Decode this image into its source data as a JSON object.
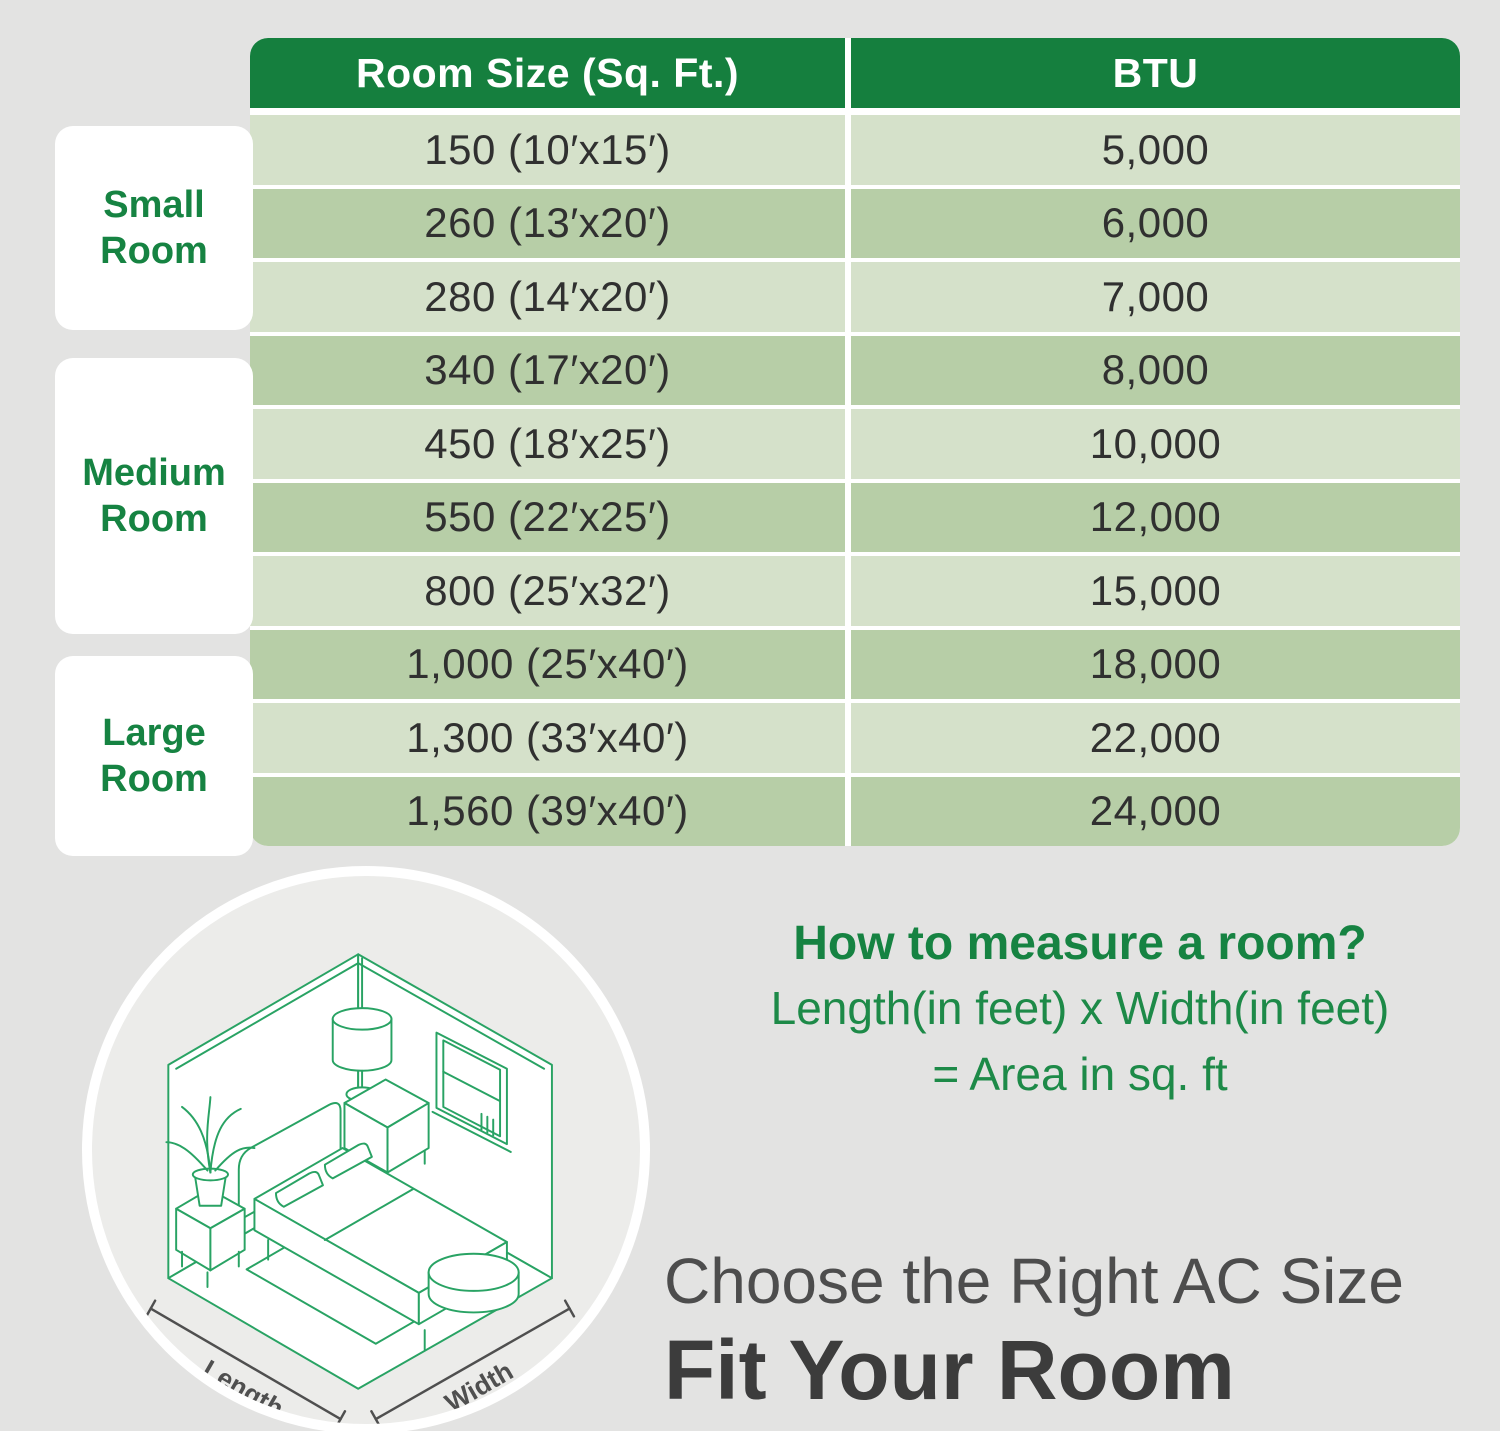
{
  "table": {
    "headers": {
      "col1": "Room Size (Sq. Ft.)",
      "col2": "BTU"
    },
    "rows": [
      {
        "size": "150 (10′x15′)",
        "btu": "5,000"
      },
      {
        "size": "260 (13′x20′)",
        "btu": "6,000"
      },
      {
        "size": "280 (14′x20′)",
        "btu": "7,000"
      },
      {
        "size": "340 (17′x20′)",
        "btu": "8,000"
      },
      {
        "size": "450 (18′x25′)",
        "btu": "10,000"
      },
      {
        "size": "550 (22′x25′)",
        "btu": "12,000"
      },
      {
        "size": "800 (25′x32′)",
        "btu": "15,000"
      },
      {
        "size": "1,000 (25′x40′)",
        "btu": "18,000"
      },
      {
        "size": "1,300 (33′x40′)",
        "btu": "22,000"
      },
      {
        "size": "1,560 (39′x40′)",
        "btu": "24,000"
      }
    ]
  },
  "categories": {
    "small": {
      "line1": "Small",
      "line2": "Room"
    },
    "medium": {
      "line1": "Medium",
      "line2": "Room"
    },
    "large": {
      "line1": "Large",
      "line2": "Room"
    }
  },
  "measure": {
    "title": "How to measure a room?",
    "line1": "Length(in feet) x Width(in feet)",
    "line2": "= Area in sq. ft"
  },
  "illustration": {
    "length_label": "Length",
    "width_label": "Width"
  },
  "footer": {
    "subtitle": "Choose the Right AC Size",
    "title": "Fit Your Room"
  },
  "colors": {
    "header_green": "#157f3e",
    "row_light": "#d5e1ca",
    "row_dark": "#b7cea7",
    "text_green": "#168342",
    "line_art_green": "#29a364",
    "background": "#e3e3e2"
  },
  "chart_data": {
    "type": "table",
    "columns": [
      "Room Size (Sq. Ft.)",
      "BTU"
    ],
    "rows": [
      [
        "150 (10′x15′)",
        "5,000"
      ],
      [
        "260 (13′x20′)",
        "6,000"
      ],
      [
        "280 (14′x20′)",
        "7,000"
      ],
      [
        "340 (17′x20′)",
        "8,000"
      ],
      [
        "450 (18′x25′)",
        "10,000"
      ],
      [
        "550 (22′x25′)",
        "12,000"
      ],
      [
        "800 (25′x32′)",
        "15,000"
      ],
      [
        "1,000 (25′x40′)",
        "18,000"
      ],
      [
        "1,300 (33′x40′)",
        "22,000"
      ],
      [
        "1,560 (39′x40′)",
        "24,000"
      ]
    ],
    "row_groups": [
      {
        "label": "Small Room",
        "rows": [
          0,
          1,
          2
        ]
      },
      {
        "label": "Medium Room",
        "rows": [
          3,
          4,
          5,
          6
        ]
      },
      {
        "label": "Large Room",
        "rows": [
          7,
          8,
          9
        ]
      }
    ]
  }
}
